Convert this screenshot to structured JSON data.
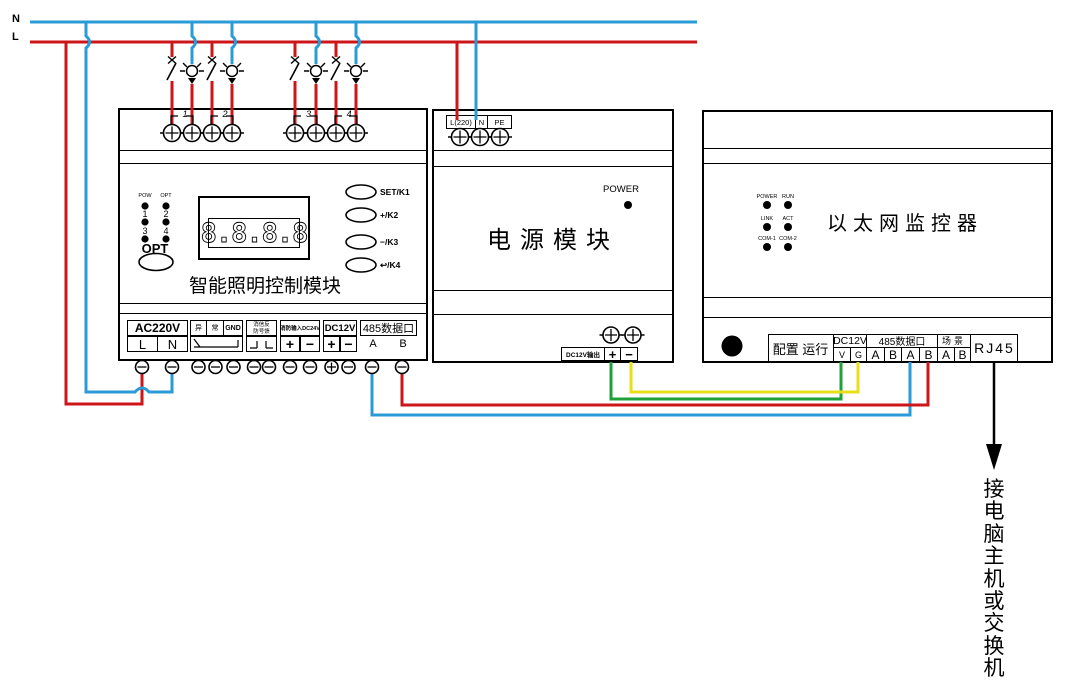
{
  "diagram": {
    "bus": {
      "n": "N",
      "l": "L"
    },
    "lighting_module": {
      "title": "智能照明控制模块",
      "relay_numbers": [
        "1",
        "2",
        "3",
        "4"
      ],
      "led_panel": {
        "col1": "POW",
        "col2": "OPT",
        "ch1": "1",
        "ch2": "2",
        "ch3": "3",
        "ch4": "4",
        "opt_button": "OPT"
      },
      "display_value": "8.8.8.8",
      "buttons": [
        "SET/K1",
        "+/K2",
        "−/K3",
        "↩/K4"
      ],
      "terminals": {
        "ac220v": "AC220V",
        "l": "L",
        "n": "N",
        "abn1": "异",
        "abn2": "常",
        "gnd": "GND",
        "fire_fb_line1": "消信反",
        "fire_fb_line2": "防号馈",
        "fire_input": "消防输入DC24V",
        "dc12v": "DC12V",
        "rs485": "485数据口",
        "plus": "+",
        "minus": "−",
        "a": "A",
        "b": "B"
      }
    },
    "power_module": {
      "title": "电源模块",
      "power_led": "POWER",
      "in1": "L(220)",
      "in2": "N",
      "in3": "PE",
      "output_label": "DC12V输出",
      "plus": "+",
      "minus": "−"
    },
    "ethernet_module": {
      "title": "以太网监控器",
      "leds": {
        "r1c1": "POWER",
        "r1c2": "RUN",
        "r2c1": "LINK",
        "r2c2": "ACT",
        "r3c1": "COM-1",
        "r3c2": "COM-2"
      },
      "terminals": {
        "config_run": "配置 运行",
        "dc12v": "DC12V",
        "v": "V",
        "g": "G",
        "rs485": "485数据口",
        "data_ab": [
          "A",
          "B",
          "A",
          "B"
        ],
        "scene": "场景",
        "scene_ab": [
          "A",
          "B"
        ],
        "rj45": "RJ45"
      }
    },
    "annotation": "接电脑主机或交换机",
    "colors": {
      "neutral_wire": "#2b9bd7",
      "live_wire": "#cd1619",
      "dc_plus_wire": "#21a038",
      "dc_minus_wire": "#e8de1a",
      "data_wire_a": "#2b9bd7",
      "data_wire_b": "#cd1619",
      "line_black": "#000000"
    }
  }
}
